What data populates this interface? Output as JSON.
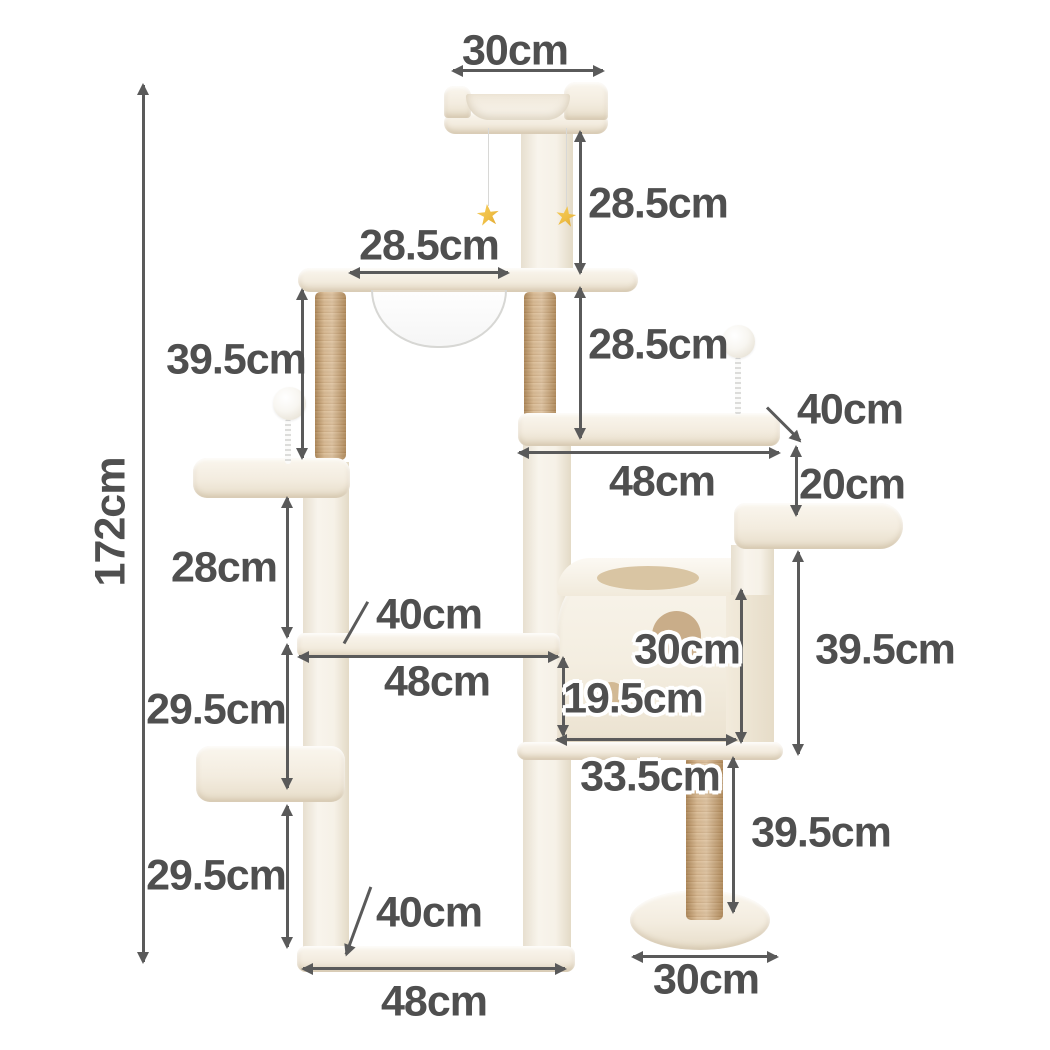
{
  "figure": {
    "kind": "cat tree product dimension diagram",
    "unit": "cm",
    "colors": {
      "background": "#ffffff",
      "label_text": "#4f4f4f",
      "arrow": "#5a5a5a",
      "plush": "#f3ecdf",
      "sisal_post": "#c8a172",
      "star_toy": "#efbf45",
      "hole_interior": "#cbb08d"
    }
  },
  "dims": {
    "top_perch_width": "30cm",
    "top_tier_height": "28.5cm",
    "upper_platform_width": "28.5cm",
    "upper_left_post_height": "39.5cm",
    "upper_right_tier_height": "28.5cm",
    "right_platform_depth": "40cm",
    "right_platform_width": "48cm",
    "right_step_height": "20cm",
    "left_tier3_height": "28cm",
    "middle_platform_depth": "40cm",
    "middle_platform_width": "48cm",
    "condo_height": "30cm",
    "condo_door_height": "19.5cm",
    "left_tier4_height": "29.5cm",
    "condo_width": "33.5cm",
    "condo_right_height": "39.5cm",
    "left_tier5_height": "29.5cm",
    "base_platform_depth": "40cm",
    "bottom_post_height": "39.5cm",
    "round_base_width": "30cm",
    "base_width": "48cm",
    "total_height": "172cm"
  }
}
